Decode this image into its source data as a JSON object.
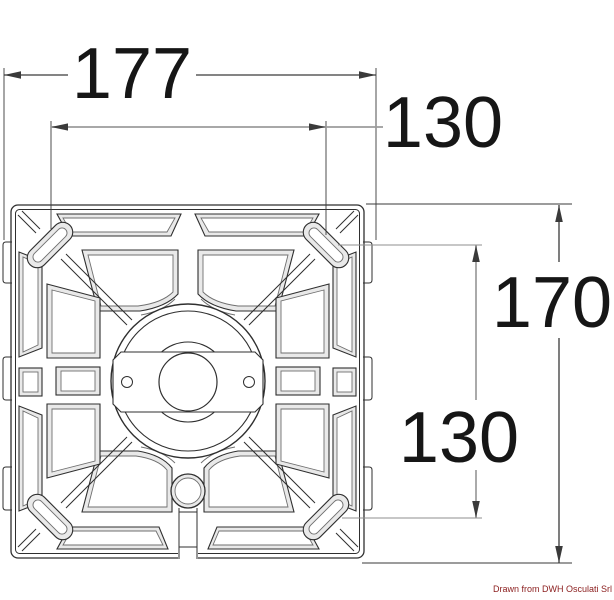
{
  "figure": {
    "type": "technical-dimension-drawing",
    "subject": "square seat swivel mounting plate, top view",
    "dims": {
      "overall_width": "177",
      "hole_spacing_horizontal": "130",
      "overall_height": "170",
      "hole_spacing_vertical": "130"
    },
    "credit": "Drawn from DWH Osculati Srl",
    "colors": {
      "line": "#2f2f2f",
      "dim_line_gray": "#9c9c9c",
      "dim_text": "#161616",
      "credit_text": "#8a1c1c",
      "bevel_fill": "#e9e9e9",
      "background": "#ffffff"
    }
  }
}
